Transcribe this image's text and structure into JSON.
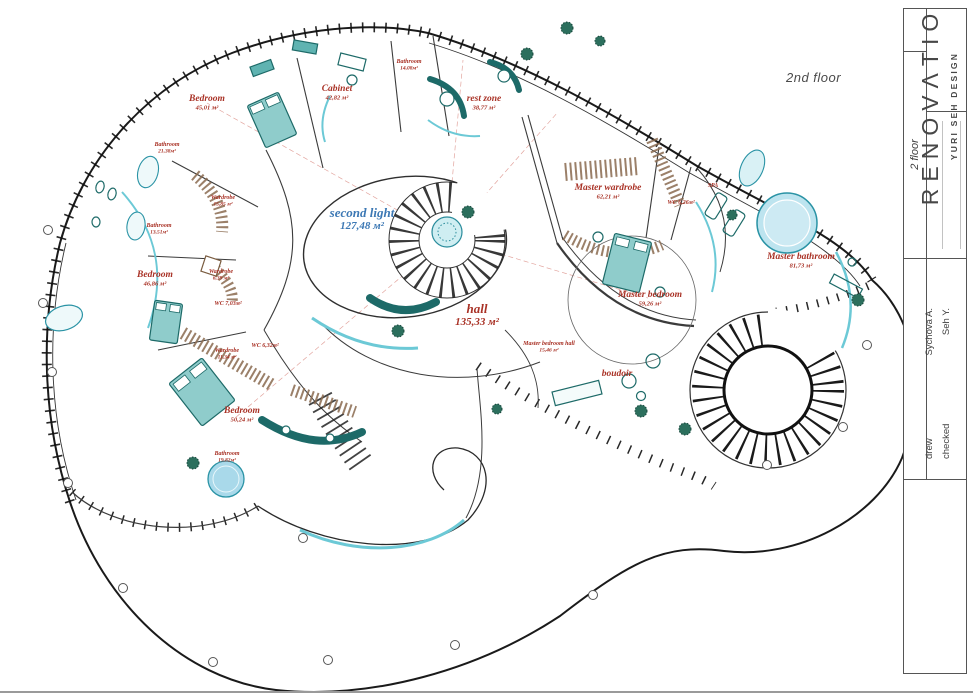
{
  "drawing": {
    "floor_label": "2nd floor",
    "title_block": {
      "floor_cell": "2 floor",
      "drew_label": "drew",
      "drew_value": "Sychova A.",
      "checked_label": "checked",
      "checked_value": "Seh Y.",
      "brand": "RENOVΛTIO",
      "brand_sub": "YURI SEH DESIGN"
    },
    "colors": {
      "label_red": "#a93226",
      "label_blue": "#3c78b4",
      "furniture_teal": "#1d6a68",
      "glass_cyan": "#6cc9d6",
      "wardrobe_brown": "#8a6a4f",
      "pool_blue": "#a9d9ea"
    },
    "rooms": [
      {
        "name": "Bedroom",
        "area": "45,01 м²",
        "x": 207,
        "y": 101,
        "size": "lg"
      },
      {
        "name": "Cabinet",
        "area": "42,82 м²",
        "x": 337,
        "y": 91,
        "size": "lg"
      },
      {
        "name": "Bathroom",
        "area": "14,08м²",
        "x": 409,
        "y": 63,
        "size": "sm"
      },
      {
        "name": "rest zone",
        "area": "38,77 м²",
        "x": 484,
        "y": 101,
        "size": "lg"
      },
      {
        "name": "Bathroom",
        "area": "21,38м²",
        "x": 167,
        "y": 146,
        "size": "sm"
      },
      {
        "name": "Wardrobe",
        "area": "15,85 м²",
        "x": 223,
        "y": 199,
        "size": "sm"
      },
      {
        "name": "Bathroom",
        "area": "13,51м²",
        "x": 159,
        "y": 227,
        "size": "sm"
      },
      {
        "name": "Bedroom",
        "area": "46,86 м²",
        "x": 155,
        "y": 277,
        "size": "lg"
      },
      {
        "name": "Wardrobe",
        "area": "6,39 м²",
        "x": 221,
        "y": 273,
        "size": "sm"
      },
      {
        "name": "WC 7,03м²",
        "area": "",
        "x": 228,
        "y": 305,
        "size": "sm"
      },
      {
        "name": "Wardrobe",
        "area": "11,34 м²",
        "x": 227,
        "y": 352,
        "size": "sm"
      },
      {
        "name": "WC 6,32м²",
        "area": "",
        "x": 265,
        "y": 347,
        "size": "sm"
      },
      {
        "name": "Bedroom",
        "area": "50,24 м²",
        "x": 242,
        "y": 413,
        "size": "lg"
      },
      {
        "name": "Bathroom",
        "area": "19,82м²",
        "x": 227,
        "y": 455,
        "size": "sm"
      },
      {
        "name": "second light",
        "area": "127,48 м²",
        "x": 362,
        "y": 217,
        "size": "xl",
        "color": "blue"
      },
      {
        "name": "hall",
        "area": "135,33 м²",
        "x": 477,
        "y": 313,
        "size": "xl"
      },
      {
        "name": "Master wardrobe",
        "area": "62,21 м²",
        "x": 608,
        "y": 190,
        "size": "lg"
      },
      {
        "name": "WC 6,26м²",
        "area": "",
        "x": 681,
        "y": 204,
        "size": "sm"
      },
      {
        "name": "SPA",
        "area": "",
        "x": 713,
        "y": 187,
        "size": "sm"
      },
      {
        "name": "Master bedroom",
        "area": "59,26 м²",
        "x": 650,
        "y": 297,
        "size": "lg"
      },
      {
        "name": "Master bedroom hall",
        "area": "15,46 м²",
        "x": 549,
        "y": 345,
        "size": "sm"
      },
      {
        "name": "boudoir",
        "area": "",
        "x": 617,
        "y": 376,
        "size": "lg"
      },
      {
        "name": "Master bathroom",
        "area": "81,73 м²",
        "x": 801,
        "y": 259,
        "size": "lg"
      }
    ]
  }
}
